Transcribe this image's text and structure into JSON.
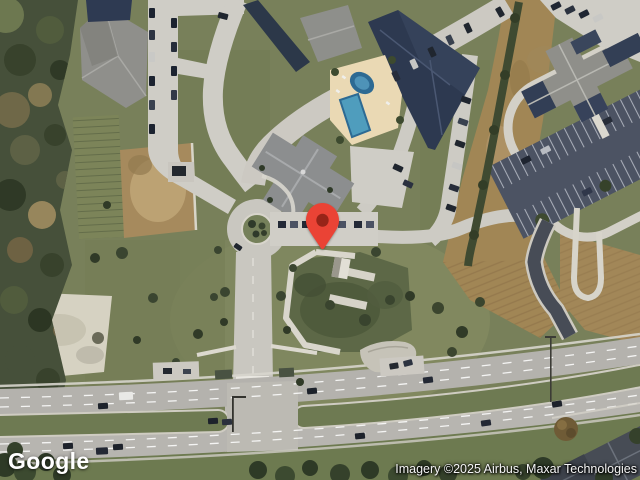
{
  "map": {
    "view_type": "satellite",
    "logo": "Google",
    "attribution": "Imagery ©2025 Airbus, Maxar Technologies",
    "marker": {
      "name": "location-pin",
      "pin_color": "#EA4335",
      "pin_dot_color": "#972418"
    },
    "palette": {
      "grass": "#78805a",
      "forest": "#46503a",
      "road": "#cfcdc6",
      "highway": "#b4b2ad",
      "median_green": "#6e7a52",
      "dirt": "#a18655",
      "sand": "#d6d2c2",
      "roof_gray": "#8f8f8a",
      "roof_navy": "#2d3950",
      "pool_water": "#4f9dbd",
      "pool_deck": "#ead9b4",
      "parking_asphalt": "#4c5363"
    }
  }
}
